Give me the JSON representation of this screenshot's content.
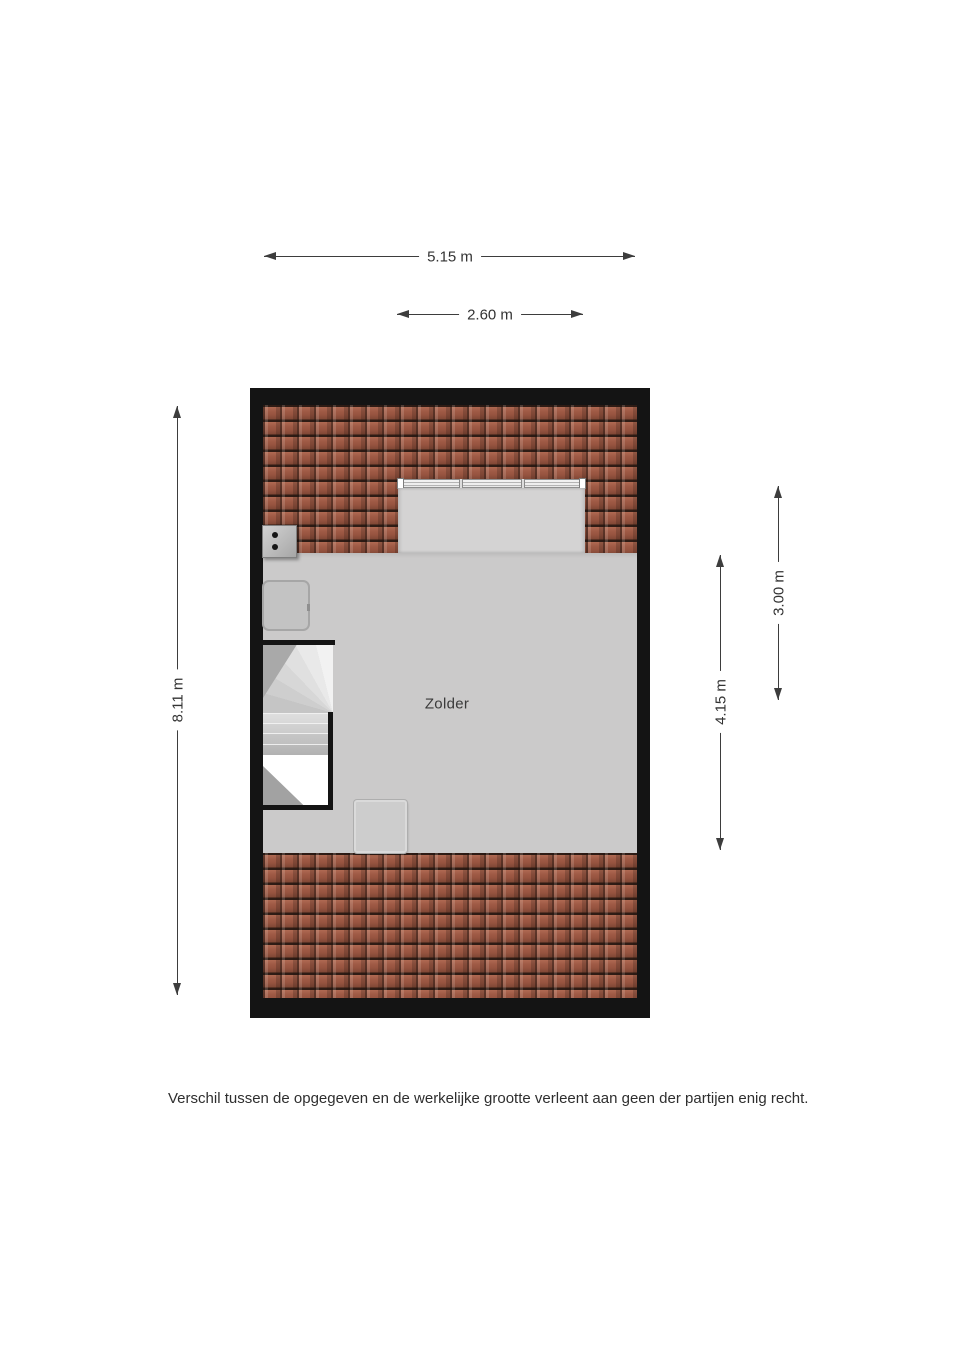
{
  "room": {
    "label": "Zolder"
  },
  "dimensions": {
    "total_width": {
      "label": "5.15 m"
    },
    "dormer_width": {
      "label": "2.60 m"
    },
    "total_height": {
      "label": "8.11 m"
    },
    "room_height": {
      "label": "4.15 m"
    },
    "dormer_height": {
      "label": "3.00 m"
    }
  },
  "footer": {
    "disclaimer": "Verschil tussen de opgegeven en de werkelijke grootte verleent aan geen der partijen enig recht."
  },
  "colors": {
    "wall": "#141414",
    "floor": "#cbcaca",
    "dormer_floor": "#d4d3d3",
    "tile": "#9c5944",
    "tile_dark": "#2f1c15",
    "dim": "#3d3d3d",
    "text": "#2e2e2e"
  }
}
